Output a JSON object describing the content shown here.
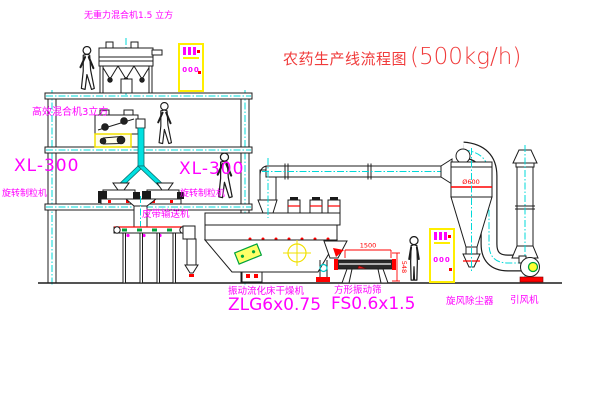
{
  "title": {
    "main": "农药生产线流程图",
    "capacity": "(500kg/h)"
  },
  "labels": {
    "gravity_mixer": "无重力混合机1.5 立方",
    "high_eff_mixer": "高效混合机3立方",
    "xl300_left": "XL-300",
    "granulator_left": "旋转制粒机",
    "xl300_center": "XL-300",
    "granulator_center": "旋转制粒机",
    "belt_conveyor": "皮带输送机",
    "dryer_name": "振动流化床干燥机",
    "dryer_model": "ZLG6x0.75",
    "screen_name": "方形振动筛",
    "screen_model": "FS0.6x1.5",
    "cyclone_name": "旋风除尘器",
    "fan_name": "引风机"
  },
  "dimensions": {
    "screen_length": "1500",
    "screen_height": "548",
    "cyclone_marking": "Ø600"
  },
  "cabinets": {
    "top_cabinet_text": "000",
    "right_cabinet_text": "000"
  },
  "colors": {
    "label_magenta": "#ff00ff",
    "title_red": "#f03b3b",
    "dimension_red": "#ff0000",
    "centerline_cyan": "#00d9d9",
    "cabinet_yellow": "#ffee00",
    "chute_cyan": "#00e0e0",
    "line_black": "#1c1c1c",
    "green_accent": "#00a33c"
  }
}
